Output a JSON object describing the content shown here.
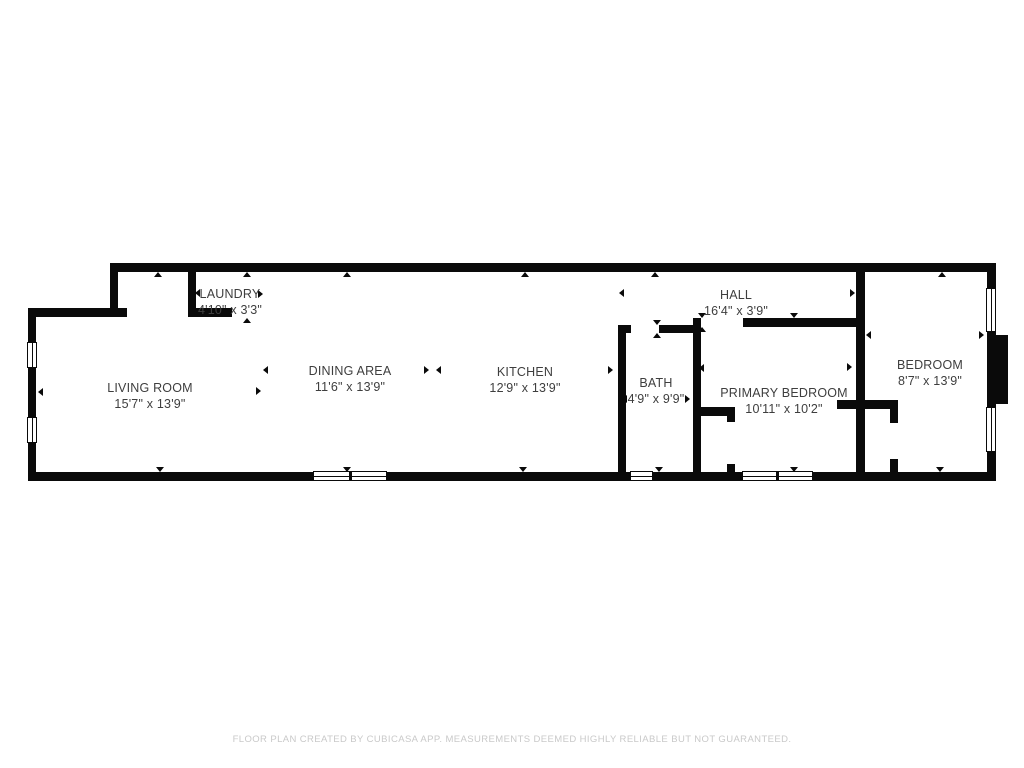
{
  "meta": {
    "background_color": "#ffffff",
    "wall_color": "#0a0a0a",
    "label_color": "#3e3e3e",
    "footer_color": "#c9c9c9"
  },
  "footer": {
    "text": "FLOOR PLAN CREATED BY CUBICASA APP. MEASUREMENTS DEEMED HIGHLY RELIABLE BUT NOT GUARANTEED."
  },
  "rooms": [
    {
      "id": "living-room",
      "label": "LIVING ROOM",
      "dims": "15'7\" x 13'9\"",
      "cx": 150,
      "cy": 388
    },
    {
      "id": "laundry",
      "label": "LAUNDRY",
      "dims": "4'10\" x 3'3\"",
      "cx": 230,
      "cy": 294
    },
    {
      "id": "dining-area",
      "label": "DINING AREA",
      "dims": "11'6\" x 13'9\"",
      "cx": 350,
      "cy": 371
    },
    {
      "id": "kitchen",
      "label": "KITCHEN",
      "dims": "12'9\" x 13'9\"",
      "cx": 525,
      "cy": 372
    },
    {
      "id": "bath",
      "label": "BATH",
      "dims": "4'9\" x 9'9\"",
      "cx": 656,
      "cy": 383
    },
    {
      "id": "hall",
      "label": "HALL",
      "dims": "16'4\" x 3'9\"",
      "cx": 736,
      "cy": 295
    },
    {
      "id": "primary-bedroom",
      "label": "PRIMARY BEDROOM",
      "dims": "10'11\" x 10'2\"",
      "cx": 784,
      "cy": 393
    },
    {
      "id": "bedroom",
      "label": "BEDROOM",
      "dims": "8'7\" x 13'9\"",
      "cx": 930,
      "cy": 365
    }
  ],
  "walls": [
    {
      "id": "top",
      "x": 110,
      "y": 263,
      "w": 885,
      "h": 9
    },
    {
      "id": "right",
      "x": 987,
      "y": 263,
      "w": 9,
      "h": 218
    },
    {
      "id": "right-pier",
      "x": 995,
      "y": 335,
      "w": 13,
      "h": 69
    },
    {
      "id": "bottom",
      "x": 28,
      "y": 472,
      "w": 967,
      "h": 9
    },
    {
      "id": "left",
      "x": 28,
      "y": 308,
      "w": 8,
      "h": 173
    },
    {
      "id": "entry-step",
      "x": 28,
      "y": 308,
      "w": 99,
      "h": 9
    },
    {
      "id": "upper-left",
      "x": 110,
      "y": 263,
      "w": 8,
      "h": 54
    },
    {
      "id": "laundry-left",
      "x": 188,
      "y": 268,
      "w": 8,
      "h": 49
    },
    {
      "id": "laundry-bottom",
      "x": 188,
      "y": 308,
      "w": 44,
      "h": 9
    },
    {
      "id": "kitchen-bath",
      "x": 618,
      "y": 325,
      "w": 8,
      "h": 156
    },
    {
      "id": "bath-top-left",
      "x": 618,
      "y": 325,
      "w": 13,
      "h": 8
    },
    {
      "id": "bath-top-right",
      "x": 659,
      "y": 325,
      "w": 42,
      "h": 8
    },
    {
      "id": "bath-primary",
      "x": 693,
      "y": 318,
      "w": 8,
      "h": 163
    },
    {
      "id": "hall-bottom",
      "x": 743,
      "y": 318,
      "w": 121,
      "h": 9
    },
    {
      "id": "primary-closet-top",
      "x": 698,
      "y": 407,
      "w": 37,
      "h": 9
    },
    {
      "id": "primary-closet-stub-top",
      "x": 727,
      "y": 414,
      "w": 8,
      "h": 8
    },
    {
      "id": "primary-closet-stub-bottom",
      "x": 727,
      "y": 464,
      "w": 8,
      "h": 9
    },
    {
      "id": "bedroom-closet-top",
      "x": 837,
      "y": 400,
      "w": 61,
      "h": 9
    },
    {
      "id": "bedroom-closet-stub-top",
      "x": 890,
      "y": 407,
      "w": 8,
      "h": 16
    },
    {
      "id": "bedroom-closet-stub-bottom",
      "x": 890,
      "y": 459,
      "w": 8,
      "h": 14
    },
    {
      "id": "primary-bedroom-right",
      "x": 856,
      "y": 263,
      "w": 9,
      "h": 218
    }
  ],
  "windows": [
    {
      "id": "left-1",
      "x": 27,
      "y": 342,
      "w": 10,
      "h": 26,
      "o": "v",
      "panes": 1
    },
    {
      "id": "left-2",
      "x": 27,
      "y": 417,
      "w": 10,
      "h": 26,
      "o": "v",
      "panes": 1
    },
    {
      "id": "right-1",
      "x": 986,
      "y": 288,
      "w": 10,
      "h": 44,
      "o": "v",
      "panes": 1
    },
    {
      "id": "right-2",
      "x": 986,
      "y": 407,
      "w": 10,
      "h": 45,
      "o": "v",
      "panes": 1
    },
    {
      "id": "bottom-living",
      "x": 313,
      "y": 471,
      "w": 74,
      "h": 10,
      "o": "h",
      "panes": 2
    },
    {
      "id": "bottom-bath",
      "x": 630,
      "y": 471,
      "w": 23,
      "h": 10,
      "o": "h",
      "panes": 1
    },
    {
      "id": "bottom-primary",
      "x": 742,
      "y": 471,
      "w": 71,
      "h": 10,
      "o": "h",
      "panes": 2
    }
  ],
  "ticks": [
    {
      "x": 158,
      "y": 272,
      "dir": "up"
    },
    {
      "x": 247,
      "y": 272,
      "dir": "up"
    },
    {
      "x": 347,
      "y": 272,
      "dir": "up"
    },
    {
      "x": 525,
      "y": 272,
      "dir": "up"
    },
    {
      "x": 655,
      "y": 272,
      "dir": "up"
    },
    {
      "x": 860,
      "y": 272,
      "dir": "up"
    },
    {
      "x": 942,
      "y": 272,
      "dir": "up"
    },
    {
      "x": 160,
      "y": 472,
      "dir": "down"
    },
    {
      "x": 347,
      "y": 472,
      "dir": "down"
    },
    {
      "x": 523,
      "y": 472,
      "dir": "down"
    },
    {
      "x": 659,
      "y": 472,
      "dir": "down"
    },
    {
      "x": 794,
      "y": 472,
      "dir": "down"
    },
    {
      "x": 940,
      "y": 472,
      "dir": "down"
    },
    {
      "x": 195,
      "y": 293,
      "dir": "left"
    },
    {
      "x": 263,
      "y": 294,
      "dir": "right"
    },
    {
      "x": 247,
      "y": 318,
      "dir": "up"
    },
    {
      "x": 38,
      "y": 392,
      "dir": "left"
    },
    {
      "x": 261,
      "y": 391,
      "dir": "right"
    },
    {
      "x": 263,
      "y": 370,
      "dir": "left"
    },
    {
      "x": 429,
      "y": 370,
      "dir": "right"
    },
    {
      "x": 436,
      "y": 370,
      "dir": "left"
    },
    {
      "x": 613,
      "y": 370,
      "dir": "right"
    },
    {
      "x": 622,
      "y": 399,
      "dir": "left"
    },
    {
      "x": 690,
      "y": 399,
      "dir": "right"
    },
    {
      "x": 619,
      "y": 293,
      "dir": "left"
    },
    {
      "x": 855,
      "y": 293,
      "dir": "right"
    },
    {
      "x": 657,
      "y": 325,
      "dir": "down"
    },
    {
      "x": 657,
      "y": 333,
      "dir": "up"
    },
    {
      "x": 702,
      "y": 318,
      "dir": "down"
    },
    {
      "x": 702,
      "y": 327,
      "dir": "up"
    },
    {
      "x": 794,
      "y": 318,
      "dir": "down"
    },
    {
      "x": 699,
      "y": 368,
      "dir": "left"
    },
    {
      "x": 852,
      "y": 367,
      "dir": "right"
    },
    {
      "x": 866,
      "y": 335,
      "dir": "left"
    },
    {
      "x": 984,
      "y": 335,
      "dir": "right"
    }
  ]
}
